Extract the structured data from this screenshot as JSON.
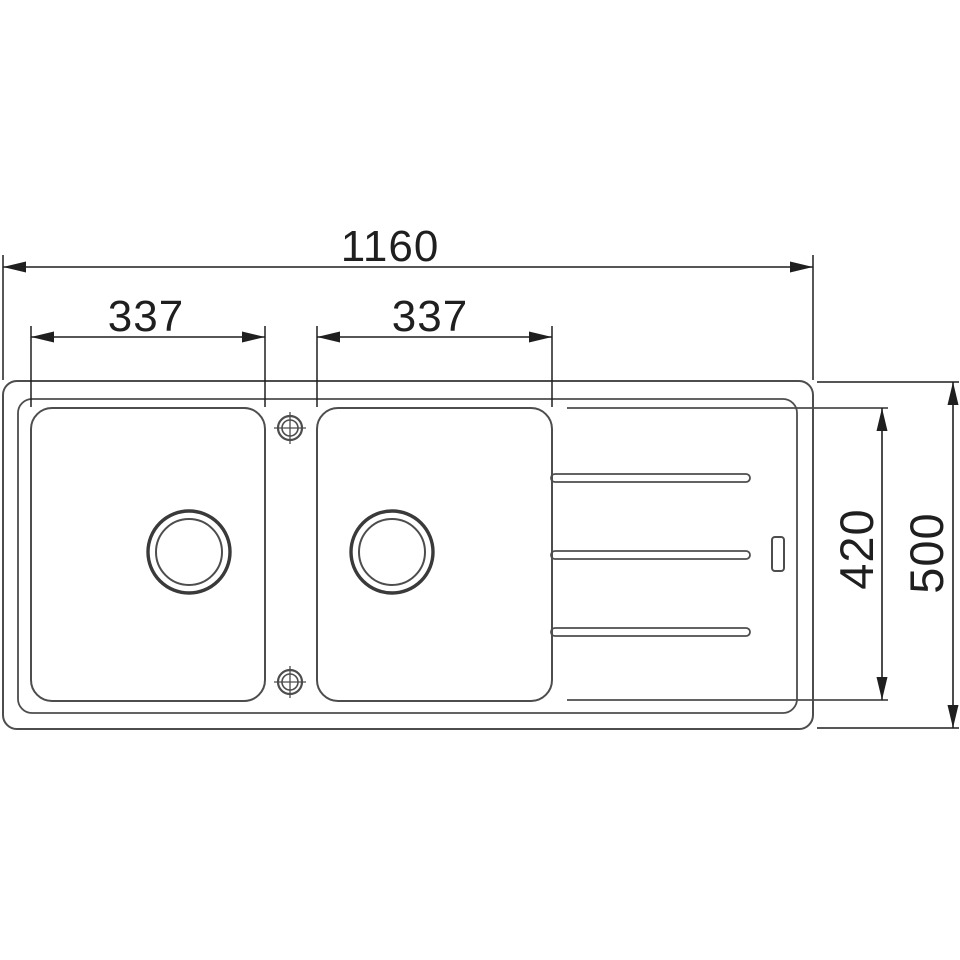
{
  "drawing": {
    "colors": {
      "background": "#ffffff",
      "sink_line": "#4d4d4d",
      "sink_line_heavy": "#3a3a3a",
      "dimension_line": "#1f1f1f"
    },
    "dimensions": {
      "overall_width": "1160",
      "left_bowl_width": "337",
      "right_bowl_width": "337",
      "bowl_depth": "420",
      "overall_depth": "500"
    }
  }
}
